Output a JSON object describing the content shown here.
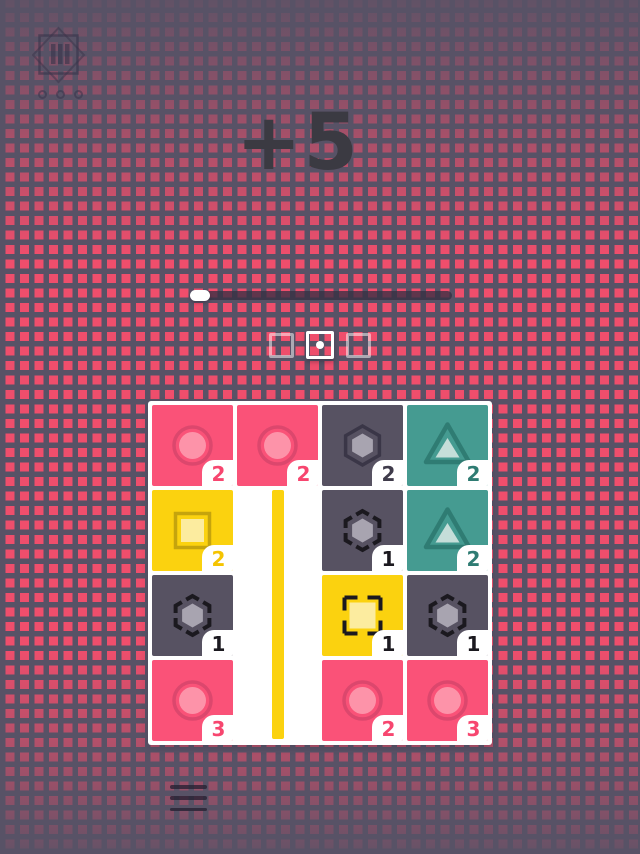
{
  "hud": {
    "score_label": "+5",
    "level_button": {
      "icon": "level-select-icon",
      "bars": 3,
      "dots": 3
    },
    "progress": {
      "value": 0.0
    },
    "level_indicators": [
      {
        "state": "inactive"
      },
      {
        "state": "active"
      },
      {
        "state": "inactive"
      }
    ],
    "menu_icon": "hamburger-menu-icon"
  },
  "board": {
    "rows": 4,
    "cols": 4,
    "stripe": {
      "color": "#FBD20F",
      "col": 1,
      "from_row": 1,
      "to_row": 3
    },
    "tiles": [
      {
        "row": 0,
        "col": 0,
        "color": "pink",
        "shape": "circle",
        "outline": "solid",
        "count": 2
      },
      {
        "row": 0,
        "col": 1,
        "color": "pink",
        "shape": "circle",
        "outline": "solid",
        "count": 2
      },
      {
        "row": 0,
        "col": 2,
        "color": "dark",
        "shape": "hexagon",
        "outline": "solid",
        "count": 2
      },
      {
        "row": 0,
        "col": 3,
        "color": "teal",
        "shape": "triangle",
        "outline": "solid",
        "count": 2
      },
      {
        "row": 1,
        "col": 0,
        "color": "yellow",
        "shape": "square",
        "outline": "solid",
        "count": 2
      },
      {
        "row": 1,
        "col": 2,
        "color": "dark",
        "shape": "hexagon",
        "outline": "dashed",
        "count": 1
      },
      {
        "row": 1,
        "col": 3,
        "color": "teal",
        "shape": "triangle",
        "outline": "solid",
        "count": 2
      },
      {
        "row": 2,
        "col": 0,
        "color": "dark",
        "shape": "hexagon",
        "outline": "dashed",
        "count": 1
      },
      {
        "row": 2,
        "col": 2,
        "color": "yellow",
        "shape": "square",
        "outline": "dashed",
        "count": 1
      },
      {
        "row": 2,
        "col": 3,
        "color": "dark",
        "shape": "hexagon",
        "outline": "dashed",
        "count": 1
      },
      {
        "row": 3,
        "col": 0,
        "color": "pink",
        "shape": "circle",
        "outline": "solid",
        "count": 3
      },
      {
        "row": 3,
        "col": 2,
        "color": "pink",
        "shape": "circle",
        "outline": "solid",
        "count": 2
      },
      {
        "row": 3,
        "col": 3,
        "color": "pink",
        "shape": "circle",
        "outline": "solid",
        "count": 3
      }
    ]
  },
  "palette": {
    "background_base": "#585266",
    "background_square": "#EF4E6C",
    "score_text": "#3B3A42",
    "board_bg": "#FFFFFF",
    "stripe_yellow": "#FBD20F",
    "dashed_outline": "#1B191F",
    "dashed_number": "#1B191F",
    "tile_colors": {
      "pink": {
        "base": "#FA5278",
        "dark": "#DC476D",
        "light": "#FD93A9",
        "number": "#F7466F"
      },
      "dark": {
        "base": "#575262",
        "dark": "#3A3647",
        "light": "#A8A4B0",
        "number": "#3F3B4A"
      },
      "teal": {
        "base": "#459B91",
        "dark": "#2F7C73",
        "light": "#C5DED9",
        "number": "#2F7C73"
      },
      "yellow": {
        "base": "#FBD20F",
        "dark": "#C5A40D",
        "light": "#FCEC9F",
        "number": "#F5C400"
      }
    }
  }
}
